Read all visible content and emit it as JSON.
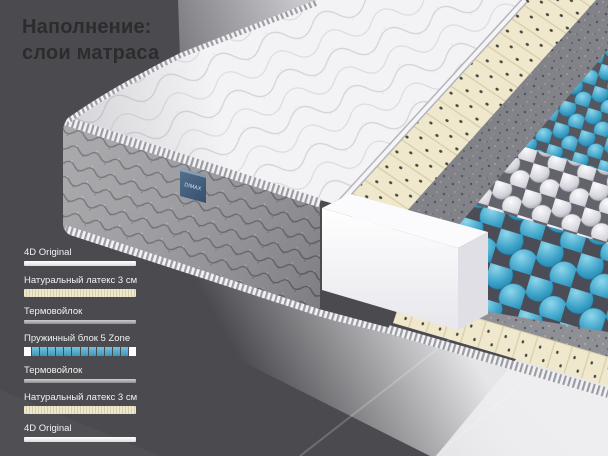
{
  "title": {
    "line1": "Наполнение:",
    "line2": "слои матраса"
  },
  "mattress": {
    "brand_tag": "DIMAX"
  },
  "layer_list": {
    "items": [
      {
        "label": "4D Original",
        "type": "fabric"
      },
      {
        "label": "Натуральный латекс 3 см",
        "type": "latex"
      },
      {
        "label": "Термовойлок",
        "type": "felt"
      },
      {
        "label": "Пружинный блок 5 Zone",
        "type": "springs",
        "segments_total": 14,
        "blue_segments": 12
      },
      {
        "label": "Термовойлок",
        "type": "felt"
      },
      {
        "label": "Натуральный латекс 3 см",
        "type": "latex"
      },
      {
        "label": "4D Original",
        "type": "fabric"
      }
    ]
  },
  "colors": {
    "background_dark": "#4b4b4f",
    "title_text": "#2c2c2f",
    "label_text": "#ffffff",
    "spring_blue": "#4aa0c6",
    "latex_cream": "#efe8cd",
    "felt_gray": "#8f8f96",
    "fabric_white": "#ffffff",
    "foam_white": "#fbfbfd",
    "tag_blue": "#3d5a7c"
  }
}
